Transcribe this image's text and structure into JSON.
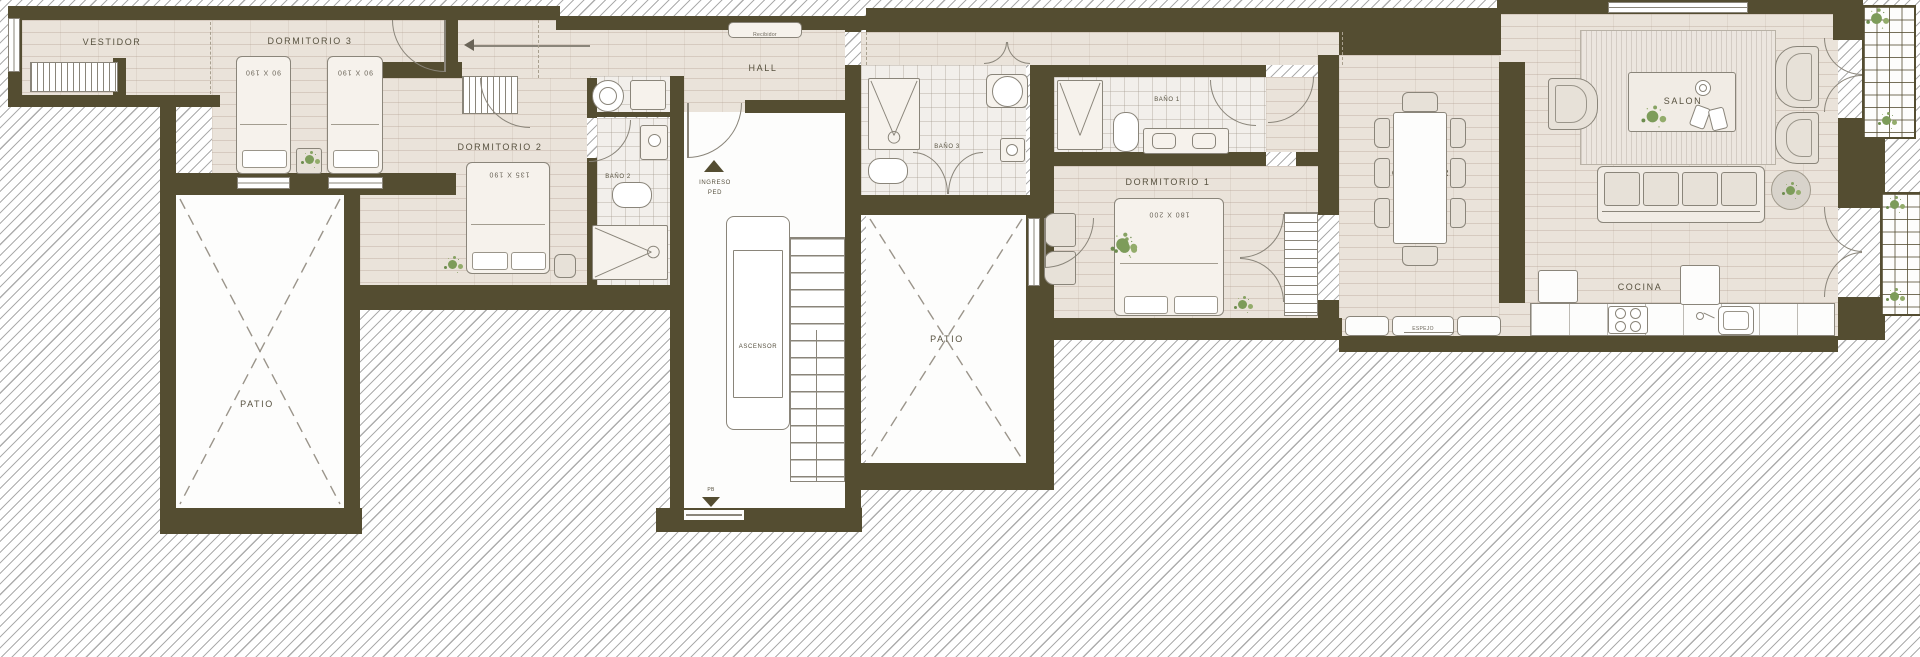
{
  "plan": {
    "title": "Floor plan",
    "rooms": {
      "vestidor": "VESTIDOR",
      "dormitorio3": "DORMITORIO 3",
      "dormitorio2": "DORMITORIO 2",
      "bano2": "BAÑO 2",
      "hall": "HALL",
      "ascensor": "ASCENSOR",
      "patio_izq": "PATIO",
      "patio_centro": "PATIO",
      "bano3": "BAÑO 3",
      "bano1": "BAÑO 1",
      "dormitorio1": "DORMITORIO 1",
      "comedor": "COMEDOR",
      "salon": "SALON",
      "cocina": "COCINA",
      "espejo": "ESPEJO"
    },
    "markers": {
      "ingreso_line1": "INGRESO",
      "ingreso_line2": "PED",
      "recibidor": "Recibidor",
      "nivel": "PB"
    },
    "bed_sizes": {
      "d3a": "90 X 190",
      "d3b": "90 X 190",
      "d2": "135 X 190",
      "d1": "180 X 200"
    },
    "colors": {
      "wall": "#544d31",
      "floor": "#eae3da",
      "bath": "#f2efeb",
      "exterior_hatch_line": "#696969",
      "plant": "#84a05c",
      "outline": "#8a857a"
    }
  }
}
